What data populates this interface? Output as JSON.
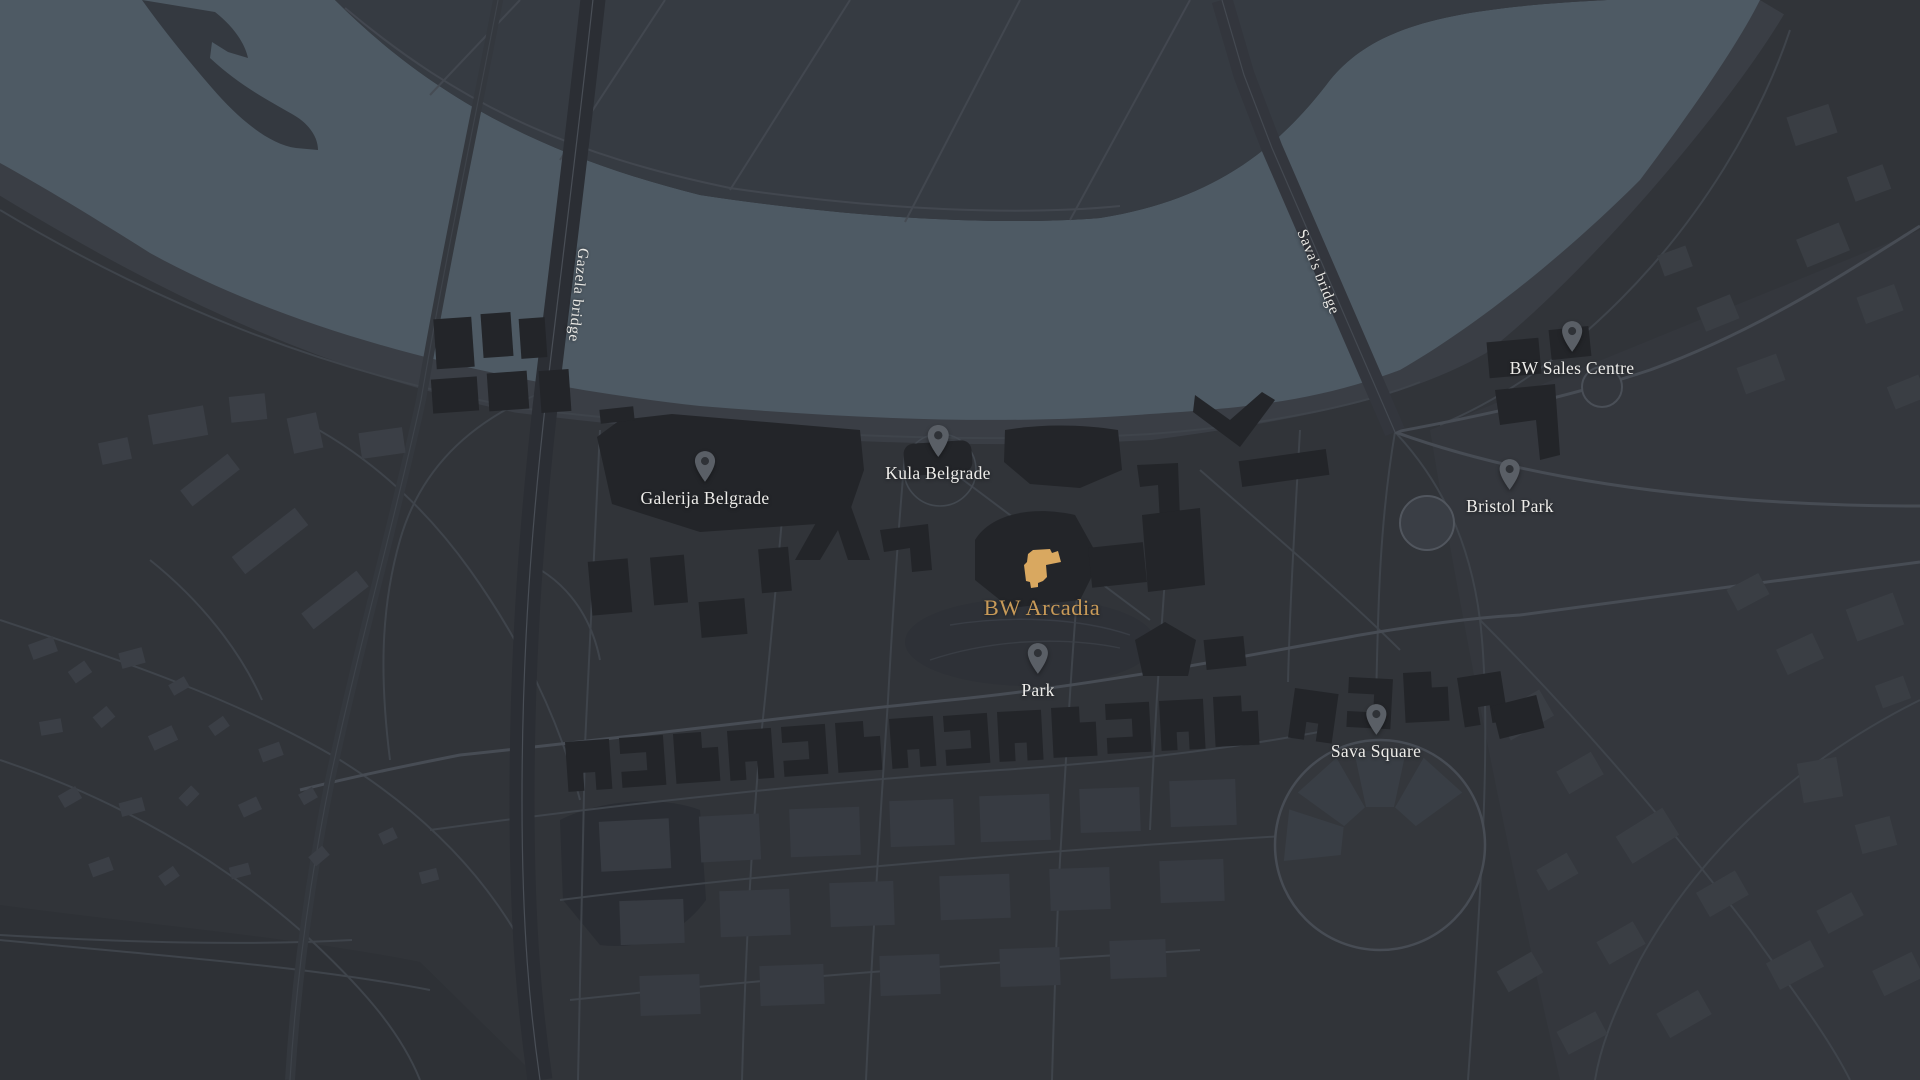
{
  "map": {
    "pois": [
      {
        "id": "galerija-belgrade",
        "label": "Galerija Belgrade"
      },
      {
        "id": "kula-belgrade",
        "label": "Kula Belgrade"
      },
      {
        "id": "bw-sales-centre",
        "label": "BW Sales Centre"
      },
      {
        "id": "bristol-park",
        "label": "Bristol Park"
      },
      {
        "id": "park",
        "label": "Park"
      },
      {
        "id": "sava-square",
        "label": "Sava Square"
      }
    ],
    "highlight": {
      "id": "bw-arcadia",
      "label": "BW Arcadia",
      "building_color": "#d9a860",
      "label_color": "#c89a58"
    },
    "bridges": [
      {
        "id": "gazela-bridge",
        "label": "Gazela bridge"
      },
      {
        "id": "savas-bridge",
        "label": "Sava's bridge"
      }
    ],
    "colors": {
      "water": "#4e5a64",
      "land": "#313439",
      "north_shore": "#363b42",
      "building_dark": "#232529",
      "building_gray": "#3b3f46",
      "road": "#43484f",
      "pin": "#5a5f66",
      "label_text": "#edece9"
    }
  }
}
